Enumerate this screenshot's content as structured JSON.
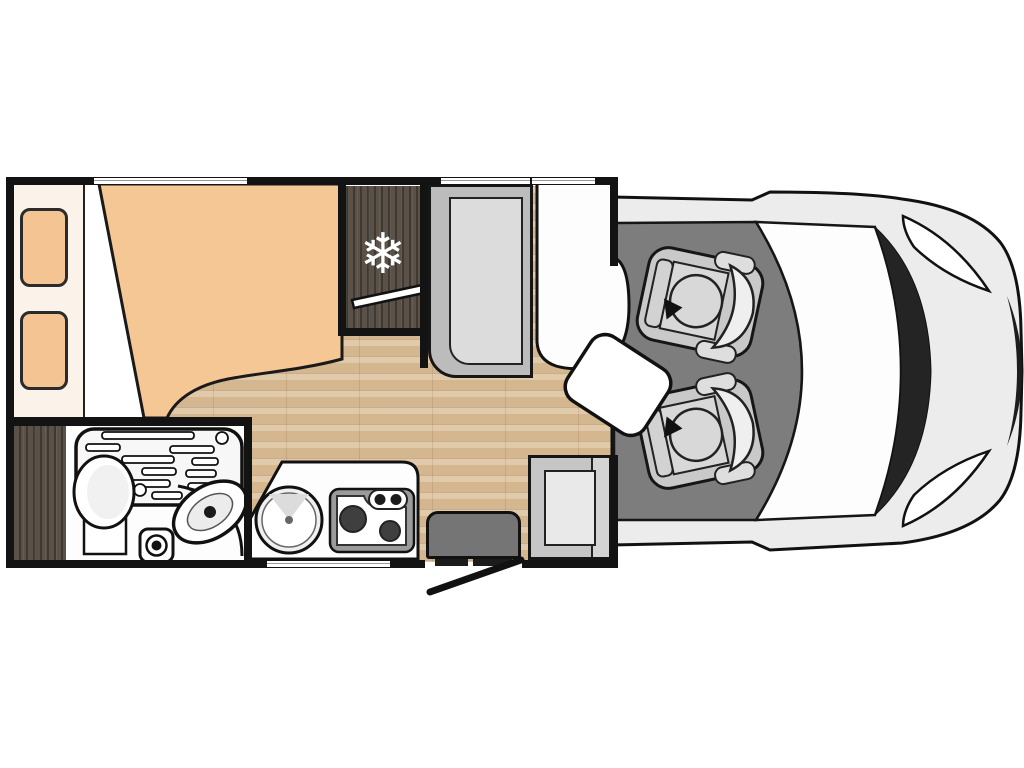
{
  "title": "Motorhome top-view floor plan",
  "colors": {
    "bg": "#ffffff",
    "wall": "#131313",
    "floor_wood": "#dcc19c",
    "dark_wood": "#5a5148",
    "headboard": "#fbf3e9",
    "pillow": "#f5c493",
    "mattress": "#f4c795",
    "bench_gray": "#bcbcbc",
    "seat_cushion": "#dcdcdc",
    "step_gray": "#757575",
    "cab_floor": "#7d7d7d",
    "van_body": "#ececec",
    "windshield_band": "#242424"
  },
  "icons": {
    "freezer": {
      "name": "snowflake-icon",
      "glyph": "❄",
      "color": "#ffffff"
    }
  },
  "components": {
    "bed": "double-bed-with-pillows",
    "wardrobe": "wardrobe-dark-wood",
    "bathroom": "bathroom-shower-basin-toilet",
    "fridge": "fridge-freezer",
    "kitchen": "kitchen-sink-and-two-burner-stove",
    "dinette_bench": "dinette-bench-seat",
    "sofa": "white-sofa-seat",
    "side_seat": "entry-side-seat",
    "entry": "entry-door-with-step",
    "table": "swivel-table",
    "cab_seats": "two-swivel-cab-seats",
    "vehicle": "van-cab-front"
  }
}
